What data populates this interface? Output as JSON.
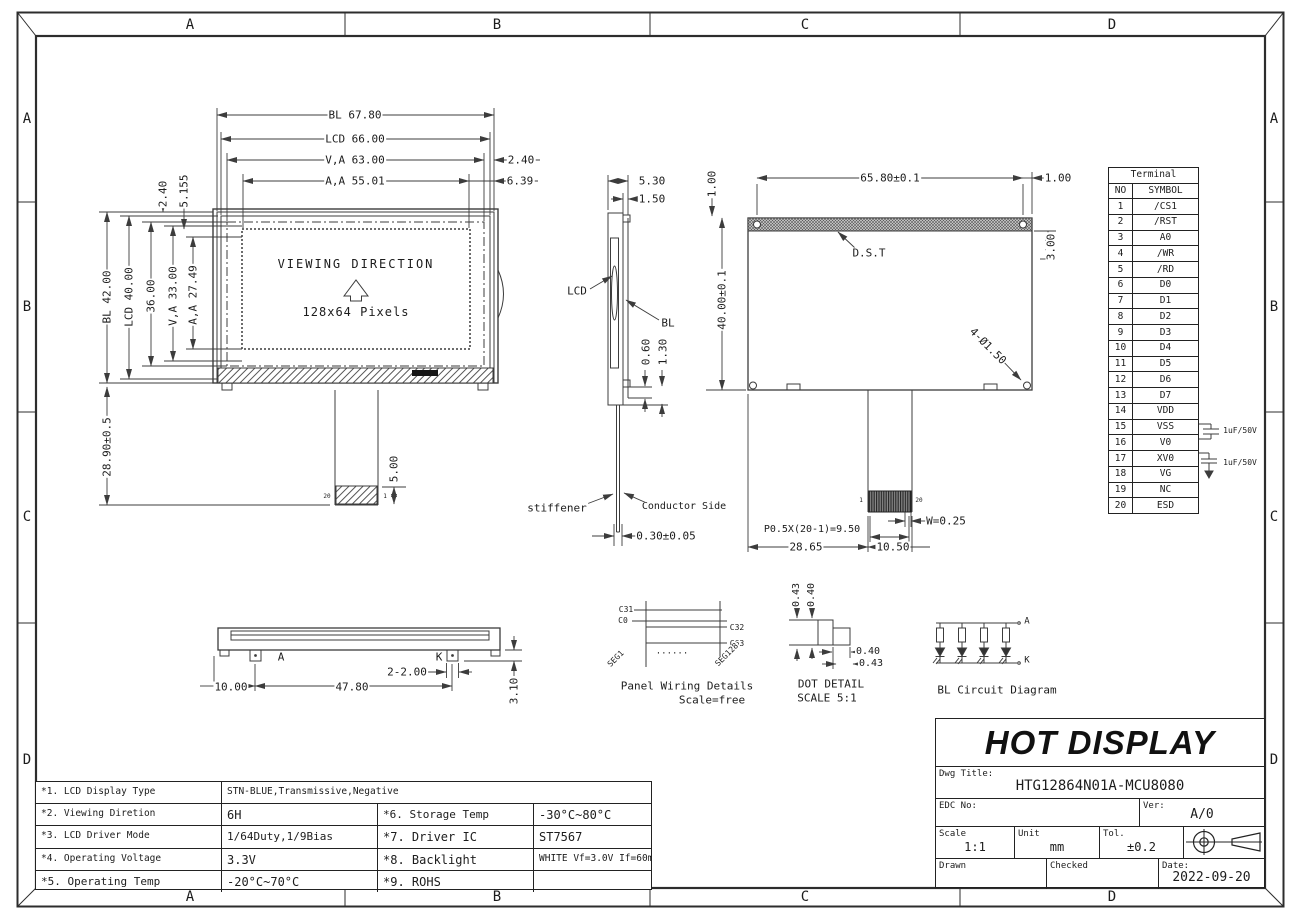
{
  "drawing_title": "HTG12864N01A-MCU8080",
  "drawing_labels": [
    {
      "t": "BL 67.80",
      "x": 355,
      "y": 115,
      "n": "dim-bl-width"
    },
    {
      "t": "LCD 66.00",
      "x": 355,
      "y": 139,
      "n": "dim-lcd-width"
    },
    {
      "t": "V,A 63.00",
      "x": 355,
      "y": 160,
      "n": "dim-va-width"
    },
    {
      "t": "2.40",
      "x": 521,
      "y": 160,
      "n": "dim-va-right-margin"
    },
    {
      "t": "A,A 55.01",
      "x": 355,
      "y": 181,
      "n": "dim-aa-width"
    },
    {
      "t": "6.39",
      "x": 520,
      "y": 181,
      "n": "dim-aa-right-margin"
    },
    {
      "t": "2.40",
      "x": 163,
      "y": 194,
      "r": -90,
      "n": "dim-top-margin-1"
    },
    {
      "t": "5.155",
      "x": 184,
      "y": 191,
      "r": -90,
      "n": "dim-top-margin-2"
    },
    {
      "t": "BL 42.00",
      "x": 107,
      "y": 297,
      "r": -90,
      "n": "dim-bl-height"
    },
    {
      "t": "LCD 40.00",
      "x": 129,
      "y": 297,
      "r": -90,
      "n": "dim-lcd-height"
    },
    {
      "t": "36.00",
      "x": 151,
      "y": 296,
      "r": -90,
      "n": "dim-36"
    },
    {
      "t": "V,A 33.00",
      "x": 173,
      "y": 296,
      "r": -90,
      "n": "dim-va-height"
    },
    {
      "t": "A,A 27.49",
      "x": 193,
      "y": 295,
      "r": -90,
      "n": "dim-aa-height"
    },
    {
      "t": "28.90±0.5",
      "x": 107,
      "y": 447,
      "r": -90,
      "n": "dim-fpc-length"
    },
    {
      "t": "VIEWING DIRECTION",
      "x": 356,
      "y": 264,
      "s": 12,
      "ls": 2,
      "n": "viewing-direction-label"
    },
    {
      "t": "128x64 Pixels",
      "x": 356,
      "y": 312,
      "s": 12,
      "ls": 1,
      "n": "resolution-label"
    },
    {
      "t": "5.00",
      "x": 394,
      "y": 469,
      "r": -90,
      "n": "dim-stiffener-5"
    },
    {
      "t": "20",
      "x": 327,
      "y": 497,
      "s": 6,
      "n": "pin20-front"
    },
    {
      "t": "1",
      "x": 385,
      "y": 497,
      "s": 6,
      "n": "pin1-front"
    },
    {
      "t": "5.30",
      "x": 652,
      "y": 181,
      "n": "dim-thickness"
    },
    {
      "t": "1.50",
      "x": 652,
      "y": 199,
      "n": "dim-1-50"
    },
    {
      "t": "LCD",
      "x": 577,
      "y": 291,
      "n": "lcd-callout"
    },
    {
      "t": "BL",
      "x": 668,
      "y": 323,
      "n": "bl-callout"
    },
    {
      "t": "0.60",
      "x": 646,
      "y": 352,
      "r": -90,
      "n": "dim-0-60"
    },
    {
      "t": "1.30",
      "x": 663,
      "y": 352,
      "r": -90,
      "n": "dim-1-30"
    },
    {
      "t": "stiffener",
      "x": 557,
      "y": 508,
      "n": "stiffener-callout"
    },
    {
      "t": "Conductor Side",
      "x": 684,
      "y": 507,
      "s": 10,
      "n": "conductor-side-callout"
    },
    {
      "t": "0.30±0.05",
      "x": 666,
      "y": 536,
      "n": "dim-fpc-thickness"
    },
    {
      "t": "65.80±0.1",
      "x": 890,
      "y": 178,
      "n": "dim-hole-span"
    },
    {
      "t": "1.00",
      "x": 1058,
      "y": 178,
      "n": "dim-hole-margin-right"
    },
    {
      "t": "1.00",
      "x": 712,
      "y": 184,
      "r": -90,
      "n": "dim-hole-margin-top"
    },
    {
      "t": "3.00",
      "x": 1051,
      "y": 247,
      "r": -90,
      "n": "dim-3-00"
    },
    {
      "t": "D.S.T",
      "x": 869,
      "y": 253,
      "n": "dst-callout"
    },
    {
      "t": "40.00±0.1",
      "x": 722,
      "y": 300,
      "r": -90,
      "n": "dim-back-height"
    },
    {
      "t": "4-Ø1.50",
      "x": 988,
      "y": 346,
      "r": 45,
      "n": "dim-holes"
    },
    {
      "t": "P0.5X(20-1)=9.50",
      "x": 812,
      "y": 530,
      "s": 10,
      "n": "dim-pin-pitch"
    },
    {
      "t": "W=0.25",
      "x": 946,
      "y": 521,
      "n": "dim-pad-width"
    },
    {
      "t": "28.65",
      "x": 806,
      "y": 547,
      "n": "dim-28-65"
    },
    {
      "t": "10.50",
      "x": 893,
      "y": 547,
      "n": "dim-10-50"
    },
    {
      "t": "1",
      "x": 861,
      "y": 501,
      "s": 6,
      "n": "pin1-back"
    },
    {
      "t": "20",
      "x": 919,
      "y": 501,
      "s": 6,
      "n": "pin20-back"
    },
    {
      "t": "A",
      "x": 281,
      "y": 657,
      "n": "anode-label"
    },
    {
      "t": "K",
      "x": 439,
      "y": 657,
      "n": "cathode-label"
    },
    {
      "t": "2-2.00",
      "x": 407,
      "y": 672,
      "n": "dim-pin-2-00"
    },
    {
      "t": "10.00",
      "x": 231,
      "y": 687,
      "n": "dim-10-00"
    },
    {
      "t": "47.80",
      "x": 352,
      "y": 687,
      "n": "dim-47-80"
    },
    {
      "t": "3.10",
      "x": 514,
      "y": 691,
      "r": -90,
      "n": "dim-3-10"
    },
    {
      "t": "C31",
      "x": 626,
      "y": 610,
      "s": 8,
      "n": "wiring-c31"
    },
    {
      "t": "C0",
      "x": 623,
      "y": 621,
      "s": 8,
      "n": "wiring-c0"
    },
    {
      "t": "C32",
      "x": 737,
      "y": 628,
      "s": 8,
      "n": "wiring-c32"
    },
    {
      "t": "C63",
      "x": 737,
      "y": 644,
      "s": 8,
      "n": "wiring-c63"
    },
    {
      "t": "SEG1",
      "x": 616,
      "y": 659,
      "r": -45,
      "s": 8,
      "n": "wiring-seg1"
    },
    {
      "t": "SEG128",
      "x": 727,
      "y": 655,
      "r": -45,
      "s": 8,
      "n": "wiring-seg128"
    },
    {
      "t": "......",
      "x": 672,
      "y": 652,
      "s": 9,
      "n": "wiring-dots"
    },
    {
      "t": "Panel Wiring Details",
      "x": 687,
      "y": 686,
      "s": 11,
      "n": "panel-wiring-caption"
    },
    {
      "t": "Scale=free",
      "x": 712,
      "y": 700,
      "s": 11,
      "n": "panel-wiring-scale"
    },
    {
      "t": "0.43",
      "x": 797,
      "y": 595,
      "r": -90,
      "s": 10,
      "n": "dot-pitch-v"
    },
    {
      "t": "0.40",
      "x": 812,
      "y": 595,
      "r": -90,
      "s": 10,
      "n": "dot-size-v"
    },
    {
      "t": "0.40",
      "x": 868,
      "y": 652,
      "s": 10,
      "n": "dot-size-h"
    },
    {
      "t": "0.43",
      "x": 871,
      "y": 664,
      "s": 10,
      "n": "dot-pitch-h"
    },
    {
      "t": "DOT DETAIL",
      "x": 831,
      "y": 684,
      "s": 11,
      "n": "dot-detail-caption"
    },
    {
      "t": "SCALE 5:1",
      "x": 827,
      "y": 698,
      "s": 11,
      "n": "dot-detail-scale"
    },
    {
      "t": "A",
      "x": 1027,
      "y": 622,
      "s": 9,
      "n": "bl-anode"
    },
    {
      "t": "K",
      "x": 1027,
      "y": 661,
      "s": 9,
      "n": "bl-cathode"
    },
    {
      "t": "BL Circuit Diagram",
      "x": 997,
      "y": 690,
      "s": 11,
      "n": "bl-circuit-caption"
    },
    {
      "t": "1uF/50V",
      "x": 1240,
      "y": 431,
      "s": 8,
      "n": "cap1-label"
    },
    {
      "t": "1uF/50V",
      "x": 1240,
      "y": 463,
      "s": 8,
      "n": "cap2-label"
    },
    {
      "t": "A",
      "x": 190,
      "y": 25,
      "s": 14,
      "n": "zone-top-a"
    },
    {
      "t": "B",
      "x": 497,
      "y": 25,
      "s": 14,
      "n": "zone-top-b"
    },
    {
      "t": "C",
      "x": 805,
      "y": 25,
      "s": 14,
      "n": "zone-top-c"
    },
    {
      "t": "D",
      "x": 1112,
      "y": 25,
      "s": 14,
      "n": "zone-top-d"
    },
    {
      "t": "A",
      "x": 190,
      "y": 897,
      "s": 14,
      "n": "zone-bottom-a"
    },
    {
      "t": "B",
      "x": 497,
      "y": 897,
      "s": 14,
      "n": "zone-bottom-b"
    },
    {
      "t": "C",
      "x": 805,
      "y": 897,
      "s": 14,
      "n": "zone-bottom-c"
    },
    {
      "t": "D",
      "x": 1112,
      "y": 897,
      "s": 14,
      "n": "zone-bottom-d"
    },
    {
      "t": "A",
      "x": 27,
      "y": 119,
      "s": 14,
      "n": "zone-left-a"
    },
    {
      "t": "B",
      "x": 27,
      "y": 307,
      "s": 14,
      "n": "zone-left-b"
    },
    {
      "t": "C",
      "x": 27,
      "y": 517,
      "s": 14,
      "n": "zone-left-c"
    },
    {
      "t": "D",
      "x": 27,
      "y": 760,
      "s": 14,
      "n": "zone-left-d"
    },
    {
      "t": "A",
      "x": 1274,
      "y": 119,
      "s": 14,
      "n": "zone-right-a"
    },
    {
      "t": "B",
      "x": 1274,
      "y": 307,
      "s": 14,
      "n": "zone-right-b"
    },
    {
      "t": "C",
      "x": 1274,
      "y": 517,
      "s": 14,
      "n": "zone-right-c"
    },
    {
      "t": "D",
      "x": 1274,
      "y": 760,
      "s": 14,
      "n": "zone-right-d"
    }
  ],
  "terminal": {
    "title": "Terminal",
    "col1": "NO",
    "col2": "SYMBOL",
    "rows": [
      [
        "1",
        "/CS1"
      ],
      [
        "2",
        "/RST"
      ],
      [
        "3",
        "A0"
      ],
      [
        "4",
        "/WR"
      ],
      [
        "5",
        "/RD"
      ],
      [
        "6",
        "D0"
      ],
      [
        "7",
        "D1"
      ],
      [
        "8",
        "D2"
      ],
      [
        "9",
        "D3"
      ],
      [
        "10",
        "D4"
      ],
      [
        "11",
        "D5"
      ],
      [
        "12",
        "D6"
      ],
      [
        "13",
        "D7"
      ],
      [
        "14",
        "VDD"
      ],
      [
        "15",
        "VSS"
      ],
      [
        "16",
        "V0"
      ],
      [
        "17",
        "XV0"
      ],
      [
        "18",
        "VG"
      ],
      [
        "19",
        "NC"
      ],
      [
        "20",
        "ESD"
      ]
    ]
  },
  "spec_table": {
    "rows": [
      [
        "*1. LCD Display Type",
        "STN-BLUE,Transmissive,Negative"
      ],
      [
        "*2. Viewing Diretion",
        "6H",
        "*6. Storage Temp",
        "-30°C~80°C"
      ],
      [
        "*3. LCD Driver Mode",
        "1/64Duty,1/9Bias",
        "*7. Driver IC",
        "ST7567"
      ],
      [
        "*4. Operating Voltage",
        "3.3V",
        "*8. Backlight",
        "WHITE Vf=3.0V If=60mA"
      ],
      [
        "*5. Operating Temp",
        "-20°C~70°C",
        "*9. ROHS",
        ""
      ]
    ]
  },
  "title_block": {
    "company": "HOT DISPLAY",
    "dwg_title_label": "Dwg Title:",
    "dwg_title": "HTG12864N01A-MCU8080",
    "edc_no_label": "EDC No:",
    "ver_label": "Ver:",
    "version": "A/0",
    "scale_label": "Scale",
    "scale": "1:1",
    "unit_label": "Unit",
    "unit": "mm",
    "tol_label": "Tol.",
    "tolerance": "±0.2",
    "drawn_label": "Drawn",
    "checked_label": "Checked",
    "date_label": "Date:",
    "date": "2022-09-20"
  }
}
